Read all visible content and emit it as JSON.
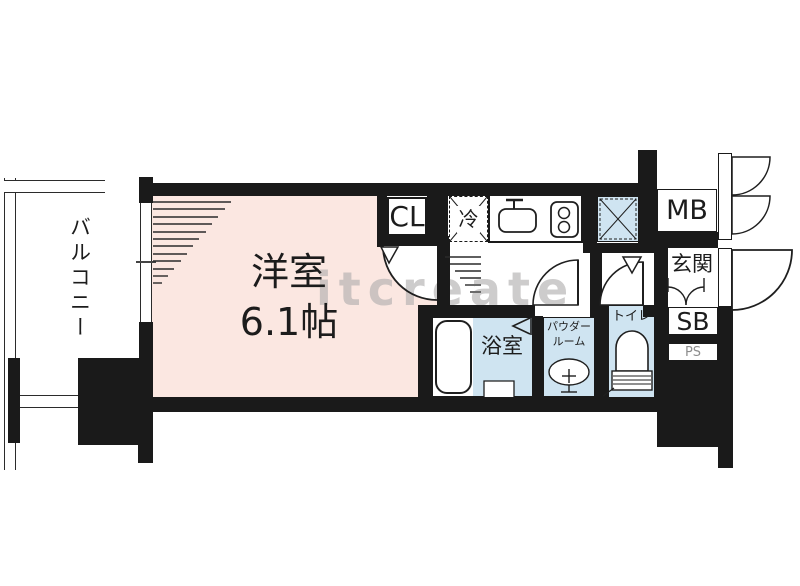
{
  "title": "apartment-floorplan",
  "watermark": "itcreate",
  "rooms": {
    "balcony": {
      "label": "バルコニー"
    },
    "main_room": {
      "label": "洋室",
      "size": "6.1帖"
    },
    "closet": {
      "label": "CL"
    },
    "refrigerator": {
      "label": "冷"
    },
    "meter_box": {
      "label": "MB"
    },
    "entrance": {
      "label": "玄関"
    },
    "shoe_box": {
      "label": "SB"
    },
    "pipe_space": {
      "label": "PS"
    },
    "bathroom": {
      "label": "浴室"
    },
    "powder_room": {
      "label_line1": "パウダー",
      "label_line2": "ルーム"
    },
    "toilet": {
      "label": "トイレ"
    }
  },
  "colors": {
    "room_pink": "#fbe7e1",
    "water_blue": "#cfe4f1",
    "wall_black": "#1a1a1a",
    "watermark_gray": "#aeacac"
  }
}
